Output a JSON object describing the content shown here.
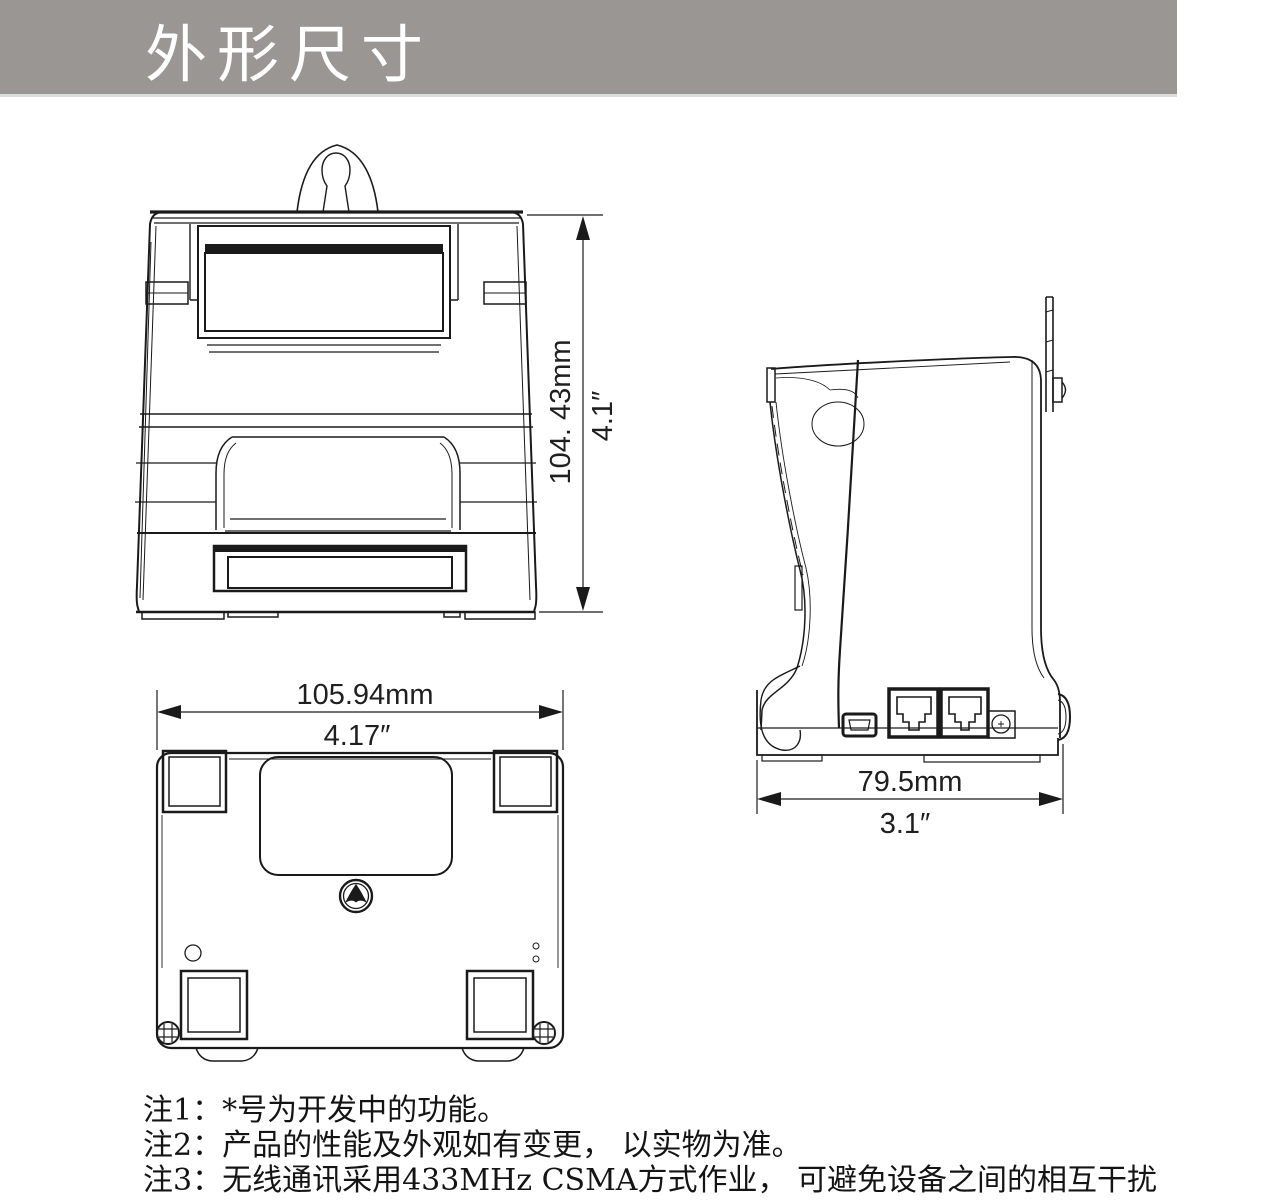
{
  "header": {
    "title": "外形尺寸"
  },
  "drawing": {
    "front_view": {
      "height_mm": "104. 43mm",
      "height_inch": "4.1″"
    },
    "bottom_view": {
      "width_mm": "105.94mm",
      "width_inch": "4.17″"
    },
    "side_view": {
      "depth_mm": "79.5mm",
      "depth_inch": "3.1″"
    }
  },
  "notes": {
    "note1": "注1：*号为开发中的功能。",
    "note2": "注2：产品的性能及外观如有变更， 以实物为准。",
    "note3": "注3：无线通讯采用433MHz CSMA方式作业， 可避免设备之间的相互干扰"
  },
  "colors": {
    "banner_bg": "#999694",
    "banner_text": "#ffffff",
    "line_color": "#1a1a1a"
  }
}
